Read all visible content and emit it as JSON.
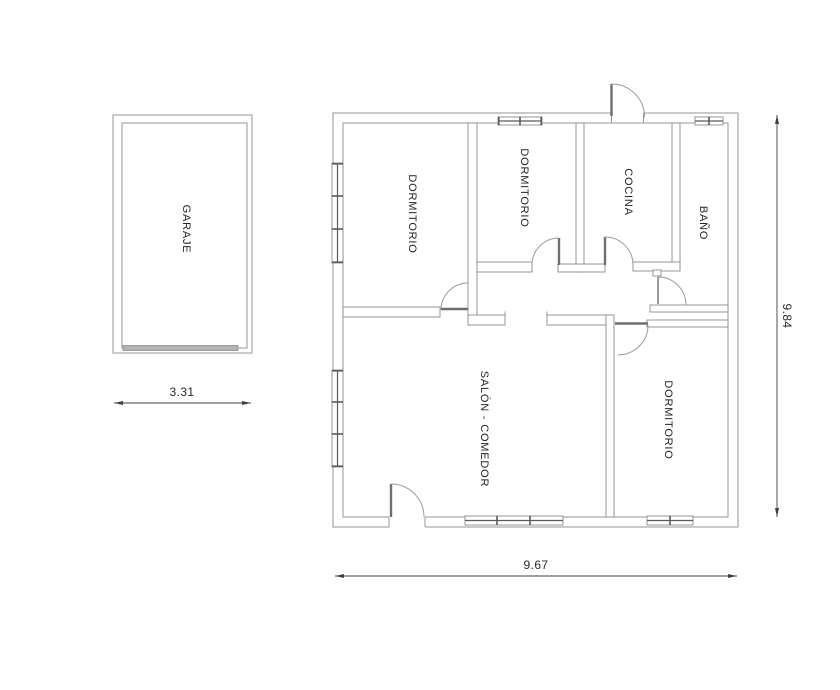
{
  "colors": {
    "wall": "#8a8a8a",
    "door": "#9a9a9a",
    "leaf": "#6e6e6e",
    "win": "#5a5a5a",
    "dim": "#3f3f3f",
    "text": "#262626",
    "garagedoor": "#b4b4b4"
  },
  "garage": {
    "label": "GARAJE",
    "width_dim": "3.31"
  },
  "plan": {
    "rooms": [
      {
        "id": "dormitorio-1",
        "label": "DORMITORIO"
      },
      {
        "id": "dormitorio-2",
        "label": "DORMITORIO"
      },
      {
        "id": "cocina",
        "label": "COCINA"
      },
      {
        "id": "bano",
        "label": "BAÑO"
      },
      {
        "id": "salon-comedor",
        "label": "SALÓN - COMEDOR"
      },
      {
        "id": "dormitorio-3",
        "label": "DORMITORIO"
      }
    ],
    "width_dim": "9.67",
    "height_dim": "9.84"
  }
}
